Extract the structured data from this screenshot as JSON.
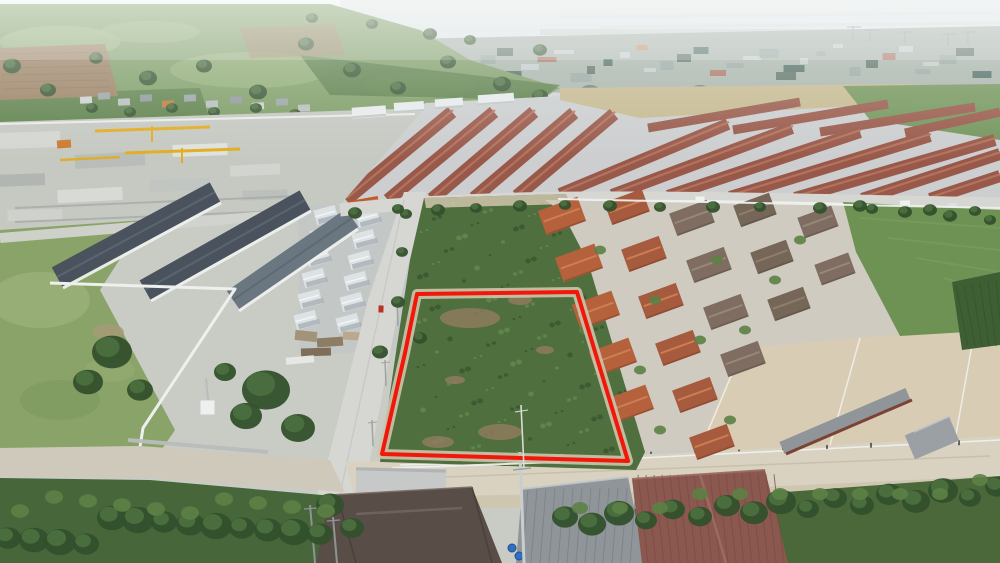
{
  "meta": {
    "image_type": "aerial-drone-photograph",
    "description": "Aerial drone photo of a vacant green scrub land plot outlined with a red boundary, beside a concrete road, surrounded by suburban housing estates with terracotta, red, slate and gray roofs, a construction site with yellow cranes, farmland, and a hazy coastal industrial city skyline on the horizon."
  },
  "land_plot": {
    "boundary_points": "417,294 577,292 628,461 382,454 405,353",
    "boundary_color": "#f1170a",
    "boundary_stroke_px": 4,
    "dirt_margin_color": "#cdc4ab",
    "vegetation_color": "#4f6f3e"
  },
  "scene_labels": [
    "hazy-sky",
    "distant-city-skyline",
    "port-cranes",
    "farmland-fields",
    "construction-site",
    "tower-cranes",
    "red-roof-townhouse-rows",
    "slate-roof-townhouses",
    "white-twin-houses",
    "concrete-road",
    "vacant-plot-red-boundary",
    "terracotta-house-rows",
    "green-field",
    "sandy-road",
    "foreground-roofs",
    "shrubs-and-trees"
  ],
  "colors": {
    "sky_haze_top": "#eff2f1",
    "sky_haze": "#d7dedd",
    "sea": "#dde4e4",
    "city_base": "#a9b3ab",
    "city_light": "#c7cecf",
    "city_mid": "#93a49f",
    "city_dark": "#53685c",
    "city_teal": "#41605a",
    "city_peach": "#c98f63",
    "city_red": "#a96a56",
    "farmland": "#7d9c64",
    "farmland_light": "#95b078",
    "farmland_dark": "#587c46",
    "dirt_field": "#9b8061",
    "tan_field": "#c7b98f",
    "tree_dark": "#33502c",
    "tree_light": "#4c7040",
    "shrub": "#5c8145",
    "concrete": "#c9cbc5",
    "road_light": "#d6d7d2",
    "road_sand": "#d9d2c0",
    "sandy_lot": "#d8ccb4",
    "sand": "#cdc4ab",
    "sand_strip": "#c9c0a6",
    "crane_yellow": "#e3ac20",
    "machine_orange": "#cd7a2e",
    "roof_row_red": "#99594a",
    "roof_row_ridge": "#b5755f",
    "roof_slate": "#49525d",
    "roof_slate_light": "#6a7680",
    "roof_slate_ridge": "#5d6873",
    "roof_white": "#dde2e5",
    "roof_white_shadow": "#aab2b8",
    "roof_orange_small": "#bf5a2d",
    "roof_terracotta": "#b4613c",
    "roof_terracotta_ridge": "#d08255",
    "roof_terracotta2": "#a65a3e",
    "roof_brown_gray": "#7e6d60",
    "roof_brown_gray2": "#756658",
    "roof_fore_brown": "#584d47",
    "roof_fore_gray": "#8f9598",
    "roof_fore_red": "#8a584e",
    "building_gray": "#9aa0a3",
    "wall_white": "#eef0ee",
    "wall_gray": "#b9bdbb",
    "field_green": "#6e9154",
    "crops_dark": "#3e5e34",
    "plot_green": "#4f6f3e",
    "plot_green_dark": "#3b5530",
    "plot_green_light": "#648a4c",
    "plot_dirt": "#8d7c5f",
    "boundary_red": "#f1170a",
    "barrel_blue": "#2f6fc2",
    "pole_gray": "#c9cdcd",
    "fence_post_dark": "#2e3234",
    "car_white": "#f0f2f2",
    "car_red": "#b83226"
  }
}
